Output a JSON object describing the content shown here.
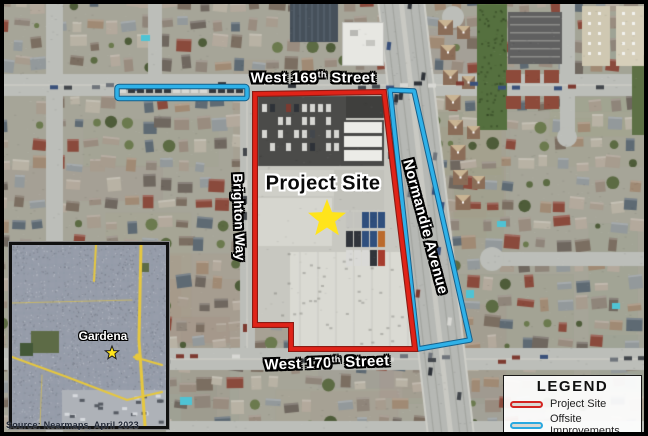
{
  "map_labels": {
    "street_169": {
      "prefix": "West 169",
      "sup": "th",
      "suffix": " Street"
    },
    "street_170": {
      "prefix": "West 170",
      "sup": "th",
      "suffix": " Street"
    },
    "brighton_way": "Brighton Way",
    "normandie_avenue": "Normandie Avenue",
    "project_site": "Project Site"
  },
  "annotations": {
    "project_site_color": "#e02318",
    "offsite_color": "#2fb1e8",
    "star_fill": "#ffe41c",
    "star_stroke": "#1a1a1a"
  },
  "inset": {
    "city_label": "Gardena"
  },
  "legend": {
    "title": "LEGEND",
    "items": [
      {
        "label": "Project Site",
        "color": "#d42420"
      },
      {
        "label": "Offsite Improvements",
        "color": "#2aa9e0"
      }
    ]
  },
  "source_note": "Source: Nearmaps, April 2023"
}
